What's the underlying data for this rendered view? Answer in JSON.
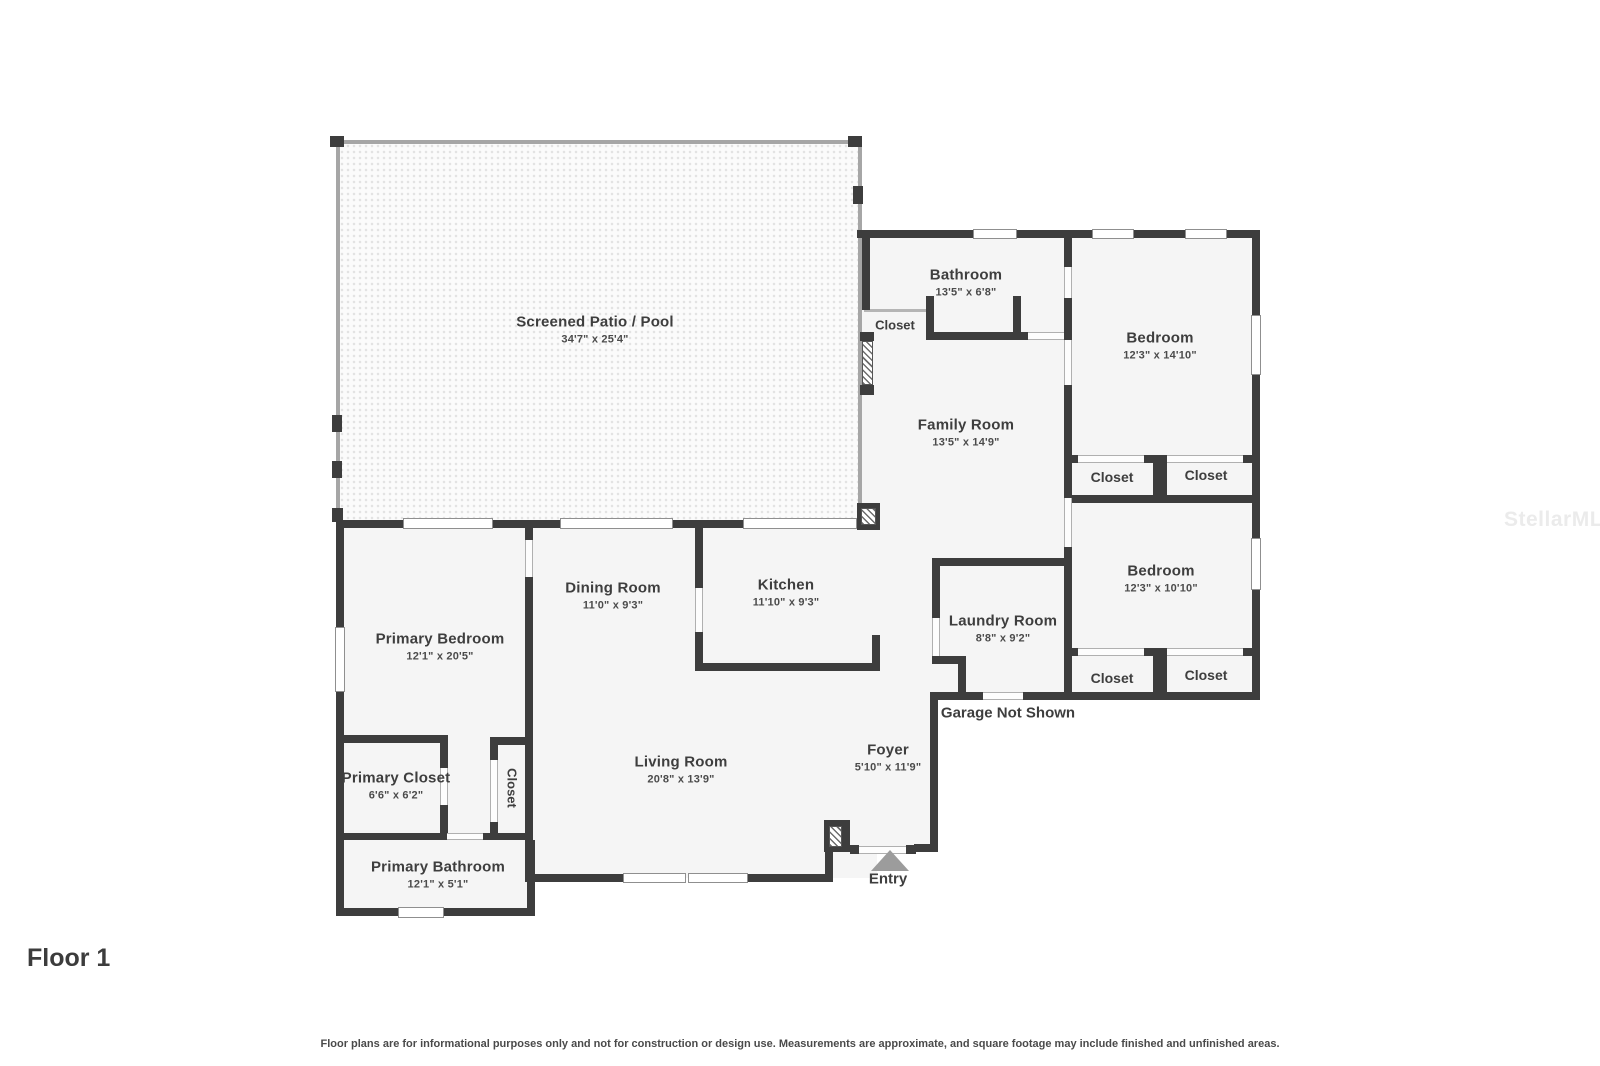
{
  "title": {
    "floor_label": "Floor 1"
  },
  "rooms": {
    "patio": {
      "name": "Screened Patio / Pool",
      "dims": "34'7\" x 25'4\""
    },
    "bathroom": {
      "name": "Bathroom",
      "dims": "13'5\" x 6'8\""
    },
    "bedroom1": {
      "name": "Bedroom",
      "dims": "12'3\" x 14'10\""
    },
    "family_room": {
      "name": "Family Room",
      "dims": "13'5\" x 14'9\""
    },
    "bedroom2": {
      "name": "Bedroom",
      "dims": "12'3\" x 10'10\""
    },
    "laundry": {
      "name": "Laundry Room",
      "dims": "8'8\" x 9'2\""
    },
    "dining": {
      "name": "Dining Room",
      "dims": "11'0\" x 9'3\""
    },
    "kitchen": {
      "name": "Kitchen",
      "dims": "11'10\" x 9'3\""
    },
    "living": {
      "name": "Living Room",
      "dims": "20'8\" x 13'9\""
    },
    "foyer": {
      "name": "Foyer",
      "dims": "5'10\" x 11'9\""
    },
    "primary_bedroom": {
      "name": "Primary Bedroom",
      "dims": "12'1\" x 20'5\""
    },
    "primary_closet": {
      "name": "Primary Closet",
      "dims": "6'6\" x 6'2\""
    },
    "primary_bathroom": {
      "name": "Primary Bathroom",
      "dims": "12'1\" x 5'1\""
    }
  },
  "labels": {
    "closet": "Closet",
    "garage": "Garage Not Shown",
    "entry": "Entry"
  },
  "footer": {
    "disclaimer": "Floor plans are for informational purposes only and not for construction or design use. Measurements are approximate, and square footage may include finished and unfinished areas."
  },
  "watermark": "StellarMLS",
  "colors": {
    "wall": "#3d3d3d",
    "room_fill": "#f5f5f5",
    "entry_marker": "#9c9c9c"
  }
}
